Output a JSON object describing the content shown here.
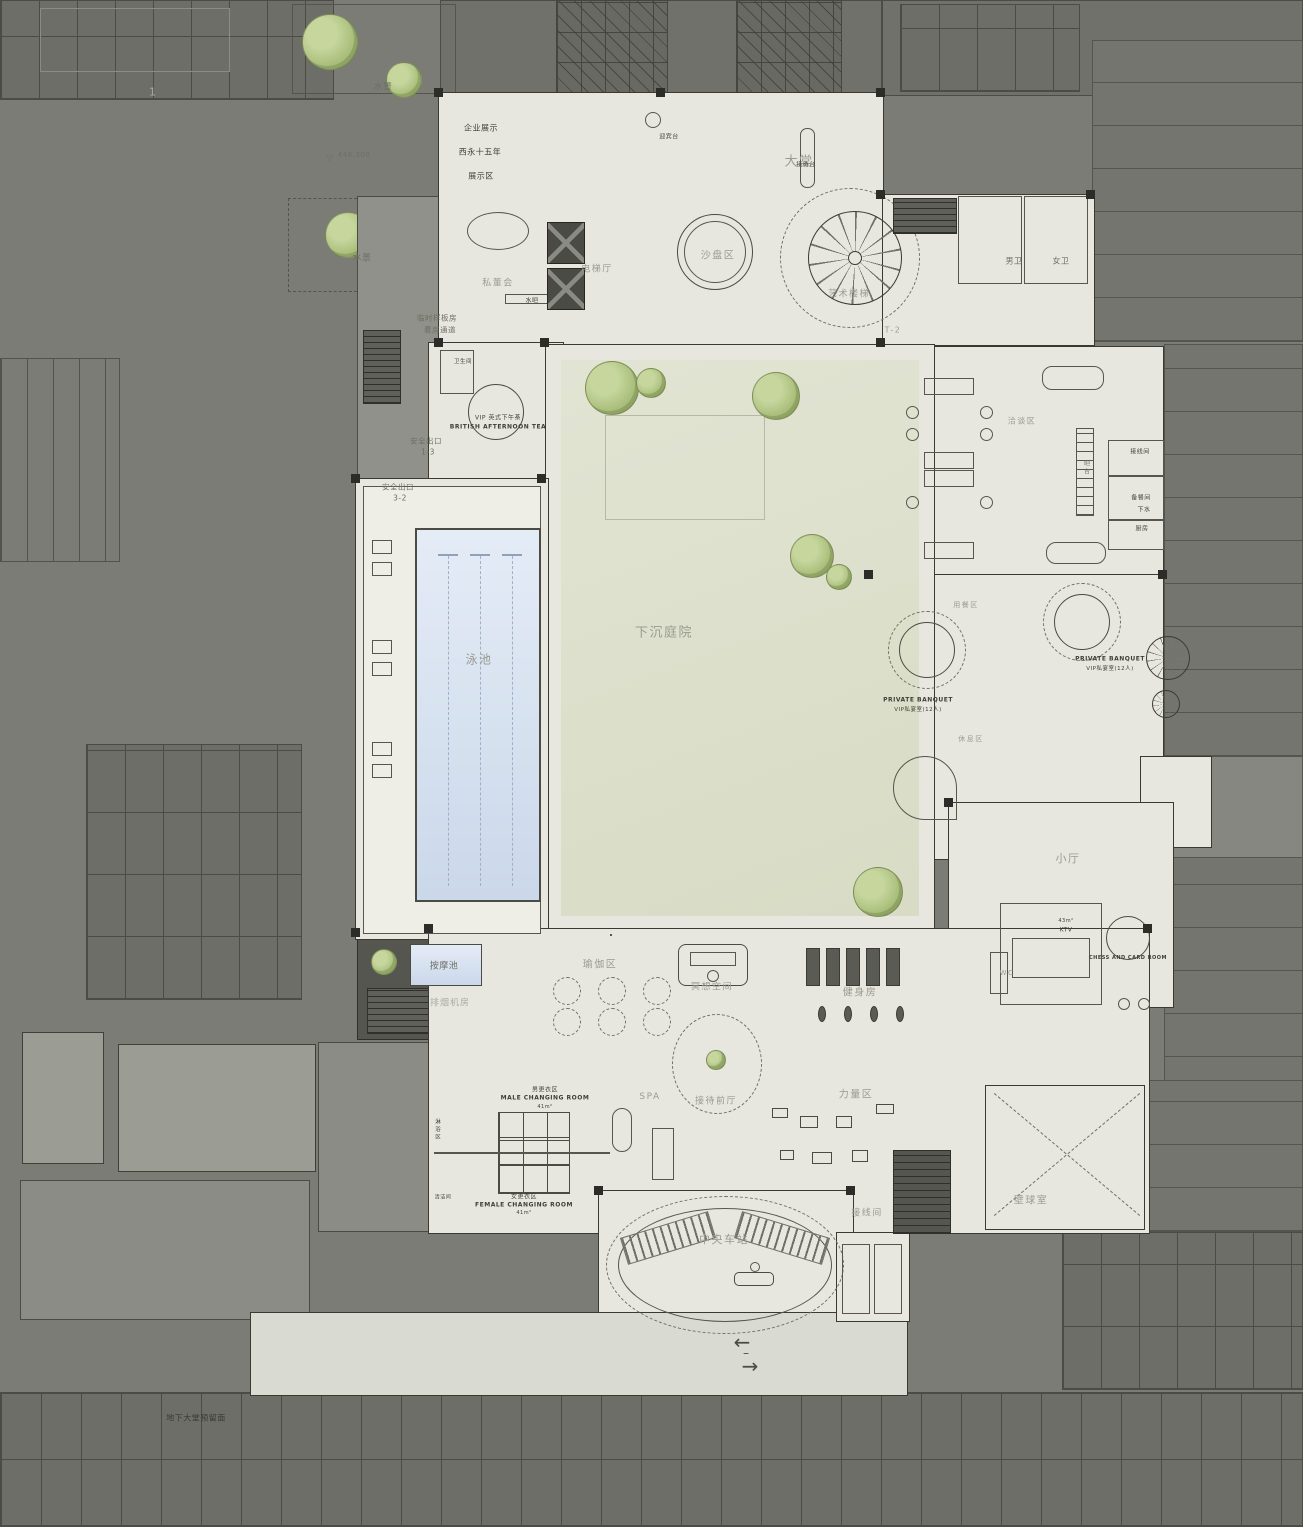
{
  "plan": {
    "type": "architectural-floor-plan",
    "level": "basement clubhouse level",
    "grid_ref": "T-2",
    "elevation_marker": "448.300"
  },
  "colors": {
    "background_gray": "#7b7c75",
    "garage_dark": "#6d6e67",
    "garage_line": "#4b4c46",
    "floor_light": "#e7e7df",
    "courtyard_green": "#dde1cc",
    "pool_blue": "#d7e2f0",
    "tree_green": "#abc07d",
    "wall_dark": "#3a3a34",
    "zone_label_gray": "#9a9b90",
    "room_label_dark": "#3e3f38",
    "apron_gray": "#d9dad1"
  },
  "icons": {
    "arrow_left": "←",
    "arrow_right": "→",
    "tick": "–",
    "level_triangle": "▽"
  },
  "labels": [
    {
      "id": "ref-1",
      "text": "1",
      "x": 153,
      "y": 92,
      "fs": 11,
      "c": "light"
    },
    {
      "id": "water-feature-top",
      "text": "水景",
      "x": 383,
      "y": 86,
      "fs": 9,
      "c": "mdark"
    },
    {
      "id": "level-mark",
      "text": "448.300",
      "x": 354,
      "y": 155,
      "fs": 7,
      "c": "mdark"
    },
    {
      "id": "water-feature-left",
      "text": "水景",
      "x": 362,
      "y": 257,
      "fs": 9,
      "c": "mdark"
    },
    {
      "id": "exhibit-line1",
      "text": "企业展示",
      "x": 481,
      "y": 128,
      "fs": 8,
      "c": "dark"
    },
    {
      "id": "exhibit-line2",
      "text": "西永十五年",
      "x": 480,
      "y": 152,
      "fs": 8,
      "c": "dark"
    },
    {
      "id": "exhibit-line3",
      "text": "展示区",
      "x": 481,
      "y": 176,
      "fs": 8,
      "c": "dark"
    },
    {
      "id": "lobby",
      "text": "大堂",
      "x": 799,
      "y": 160,
      "fs": 13,
      "c": "muted"
    },
    {
      "id": "greeting-desk",
      "text": "迎宾台",
      "x": 669,
      "y": 136,
      "fs": 6,
      "c": "dark"
    },
    {
      "id": "reception-desk",
      "text": "接待台",
      "x": 806,
      "y": 164,
      "fs": 6,
      "c": "dark"
    },
    {
      "id": "sand-table-area",
      "text": "沙盘区",
      "x": 718,
      "y": 254,
      "fs": 10,
      "c": "muted"
    },
    {
      "id": "art-staircase",
      "text": "艺术楼梯",
      "x": 849,
      "y": 293,
      "fs": 9,
      "c": "muted"
    },
    {
      "id": "private-board-room",
      "text": "私董会",
      "x": 498,
      "y": 282,
      "fs": 9,
      "c": "muted"
    },
    {
      "id": "water-bar",
      "text": "水吧",
      "x": 532,
      "y": 300,
      "fs": 6,
      "c": "dark"
    },
    {
      "id": "elevator-hall",
      "text": "电梯厅",
      "x": 597,
      "y": 268,
      "fs": 9,
      "c": "muted"
    },
    {
      "id": "mens-toilet",
      "text": "男卫",
      "x": 1014,
      "y": 261,
      "fs": 8,
      "c": "mdark"
    },
    {
      "id": "womens-toilet",
      "text": "女卫",
      "x": 1061,
      "y": 261,
      "fs": 8,
      "c": "mdark"
    },
    {
      "id": "grid-ref",
      "text": "T-2",
      "x": 893,
      "y": 330,
      "fs": 8,
      "c": "muted"
    },
    {
      "id": "temp-model-line1",
      "text": "临时样板房",
      "x": 437,
      "y": 318,
      "fs": 7.5,
      "c": "mdark"
    },
    {
      "id": "temp-model-line2",
      "text": "看房通道",
      "x": 440,
      "y": 330,
      "fs": 7.5,
      "c": "mdark"
    },
    {
      "id": "safety-exit-13",
      "text": "安全出口",
      "x": 426,
      "y": 441,
      "fs": 7.5,
      "c": "mdark"
    },
    {
      "id": "safety-exit-13b",
      "text": "1-3",
      "x": 428,
      "y": 452,
      "fs": 7.5,
      "c": "mdark"
    },
    {
      "id": "safety-exit-32",
      "text": "安全出口",
      "x": 398,
      "y": 487,
      "fs": 7.5,
      "c": "mdark"
    },
    {
      "id": "safety-exit-32b",
      "text": "3-2",
      "x": 400,
      "y": 498,
      "fs": 7.5,
      "c": "mdark"
    },
    {
      "id": "tea-washroom",
      "text": "卫生间",
      "x": 463,
      "y": 361,
      "fs": 5.5,
      "c": "dark"
    },
    {
      "id": "vip-tea-cn",
      "text": "VIP 英式下午茶",
      "x": 498,
      "y": 417,
      "fs": 6,
      "c": "dark"
    },
    {
      "id": "vip-tea-en",
      "text": "BRITISH AFTERNOON TEA",
      "x": 498,
      "y": 427,
      "fs": 6,
      "c": "dark",
      "b": true
    },
    {
      "id": "pool",
      "text": "泳池",
      "x": 479,
      "y": 659,
      "fs": 12,
      "c": "muted"
    },
    {
      "id": "massage-pool",
      "text": "按摩池",
      "x": 444,
      "y": 965,
      "fs": 9,
      "c": "mdark"
    },
    {
      "id": "smoke-exhaust-room",
      "text": "排烟机房",
      "x": 450,
      "y": 1002,
      "fs": 9,
      "c": "light"
    },
    {
      "id": "sunken-courtyard",
      "text": "下沉庭院",
      "x": 664,
      "y": 631,
      "fs": 13,
      "c": "muted"
    },
    {
      "id": "negotiation-area",
      "text": "洽谈区",
      "x": 1022,
      "y": 421,
      "fs": 8,
      "c": "muted"
    },
    {
      "id": "bar-counter",
      "text": "吧台",
      "x": 1086,
      "y": 468,
      "fs": 6,
      "c": "mdark",
      "v": true
    },
    {
      "id": "wiring-room-right",
      "text": "接线间",
      "x": 1140,
      "y": 451,
      "fs": 6,
      "c": "dark"
    },
    {
      "id": "prep-room",
      "text": "备餐间",
      "x": 1141,
      "y": 497,
      "fs": 6,
      "c": "dark"
    },
    {
      "id": "drain",
      "text": "下水",
      "x": 1144,
      "y": 509,
      "fs": 6,
      "c": "dark"
    },
    {
      "id": "kitchen",
      "text": "厨房",
      "x": 1142,
      "y": 528,
      "fs": 6,
      "c": "dark"
    },
    {
      "id": "dining-area",
      "text": "用餐区",
      "x": 966,
      "y": 605,
      "fs": 7,
      "c": "muted"
    },
    {
      "id": "banquet1-en",
      "text": "PRIVATE BANQUET",
      "x": 918,
      "y": 700,
      "fs": 6,
      "c": "dark",
      "b": true
    },
    {
      "id": "banquet1-cn",
      "text": "VIP私宴室(12人)",
      "x": 918,
      "y": 709,
      "fs": 5.5,
      "c": "dark"
    },
    {
      "id": "rest-area",
      "text": "休息区",
      "x": 971,
      "y": 739,
      "fs": 7,
      "c": "muted"
    },
    {
      "id": "banquet2-en",
      "text": "PRIVATE BANQUET",
      "x": 1110,
      "y": 659,
      "fs": 6,
      "c": "dark",
      "b": true
    },
    {
      "id": "banquet2-cn",
      "text": "VIP私宴室(12人)",
      "x": 1110,
      "y": 668,
      "fs": 5.5,
      "c": "dark"
    },
    {
      "id": "small-hall",
      "text": "小厅",
      "x": 1068,
      "y": 858,
      "fs": 11,
      "c": "muted"
    },
    {
      "id": "ktv-area",
      "text": "43m²",
      "x": 1066,
      "y": 921,
      "fs": 5,
      "c": "dark"
    },
    {
      "id": "ktv",
      "text": "KTV",
      "x": 1066,
      "y": 930,
      "fs": 6,
      "c": "dark"
    },
    {
      "id": "wc",
      "text": "WC",
      "x": 1007,
      "y": 973,
      "fs": 7,
      "c": "muted"
    },
    {
      "id": "chess-card-room",
      "text": "CHESS AND CARD ROOM",
      "x": 1128,
      "y": 958,
      "fs": 5,
      "c": "dark",
      "b": true
    },
    {
      "id": "yoga-area",
      "text": "瑜伽区",
      "x": 600,
      "y": 963,
      "fs": 10,
      "c": "muted"
    },
    {
      "id": "meditation-space",
      "text": "冥想空间",
      "x": 712,
      "y": 986,
      "fs": 9,
      "c": "muted"
    },
    {
      "id": "gym",
      "text": "健身房",
      "x": 860,
      "y": 991,
      "fs": 10,
      "c": "muted"
    },
    {
      "id": "reception-front-hall",
      "text": "接待前厅",
      "x": 716,
      "y": 1100,
      "fs": 9,
      "c": "muted"
    },
    {
      "id": "strength-area",
      "text": "力量区",
      "x": 856,
      "y": 1093,
      "fs": 10,
      "c": "muted"
    },
    {
      "id": "spa",
      "text": "SPA",
      "x": 650,
      "y": 1097,
      "fs": 9,
      "c": "muted"
    },
    {
      "id": "male-changing-cn",
      "text": "男更衣区",
      "x": 545,
      "y": 1089,
      "fs": 6,
      "c": "dark"
    },
    {
      "id": "male-changing-en",
      "text": "MALE CHANGING ROOM",
      "x": 545,
      "y": 1098,
      "fs": 6,
      "c": "dark",
      "b": true
    },
    {
      "id": "male-changing-area",
      "text": "41m²",
      "x": 545,
      "y": 1107,
      "fs": 5,
      "c": "dark"
    },
    {
      "id": "female-changing-cn",
      "text": "女更衣区",
      "x": 524,
      "y": 1196,
      "fs": 6,
      "c": "dark"
    },
    {
      "id": "female-changing-en",
      "text": "FEMALE CHANGING ROOM",
      "x": 524,
      "y": 1205,
      "fs": 6,
      "c": "dark",
      "b": true
    },
    {
      "id": "female-changing-area",
      "text": "41m²",
      "x": 524,
      "y": 1213,
      "fs": 5,
      "c": "dark"
    },
    {
      "id": "shower-area",
      "text": "淋浴区",
      "x": 437,
      "y": 1130,
      "fs": 5.5,
      "c": "dark",
      "v": true
    },
    {
      "id": "cleaning-room",
      "text": "清洁间",
      "x": 443,
      "y": 1197,
      "fs": 5,
      "c": "dark"
    },
    {
      "id": "wiring-room-bottom",
      "text": "接线间",
      "x": 867,
      "y": 1212,
      "fs": 9,
      "c": "muted"
    },
    {
      "id": "squash-room",
      "text": "壁球室",
      "x": 1031,
      "y": 1199,
      "fs": 10,
      "c": "muted"
    },
    {
      "id": "central-station",
      "text": "中央车站",
      "x": 724,
      "y": 1239,
      "fs": 11,
      "c": "muted"
    },
    {
      "id": "basement-lobby-note",
      "text": "地下大堂预留面",
      "x": 196,
      "y": 1418,
      "fs": 8,
      "c": "note"
    }
  ]
}
